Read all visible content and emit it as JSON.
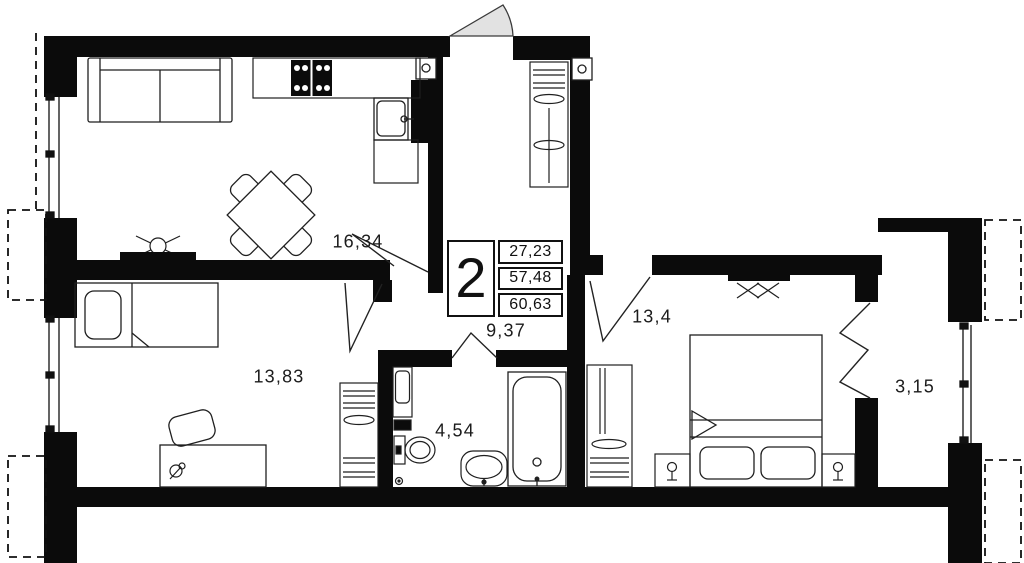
{
  "floorplan": {
    "unit_box": {
      "rooms_count": "2",
      "areas": [
        "27,23",
        "57,48",
        "60,63"
      ]
    },
    "room_labels": {
      "living_kitchen": "16,34",
      "second_room": "13,83",
      "hallway": "9,37",
      "bathroom": "4,54",
      "bedroom": "13,4",
      "balcony": "3,15"
    },
    "colors": {
      "walls": "#0b0b0b",
      "door_swing_fill": "#e2e2e2",
      "lines": "#1f1f1f"
    }
  }
}
